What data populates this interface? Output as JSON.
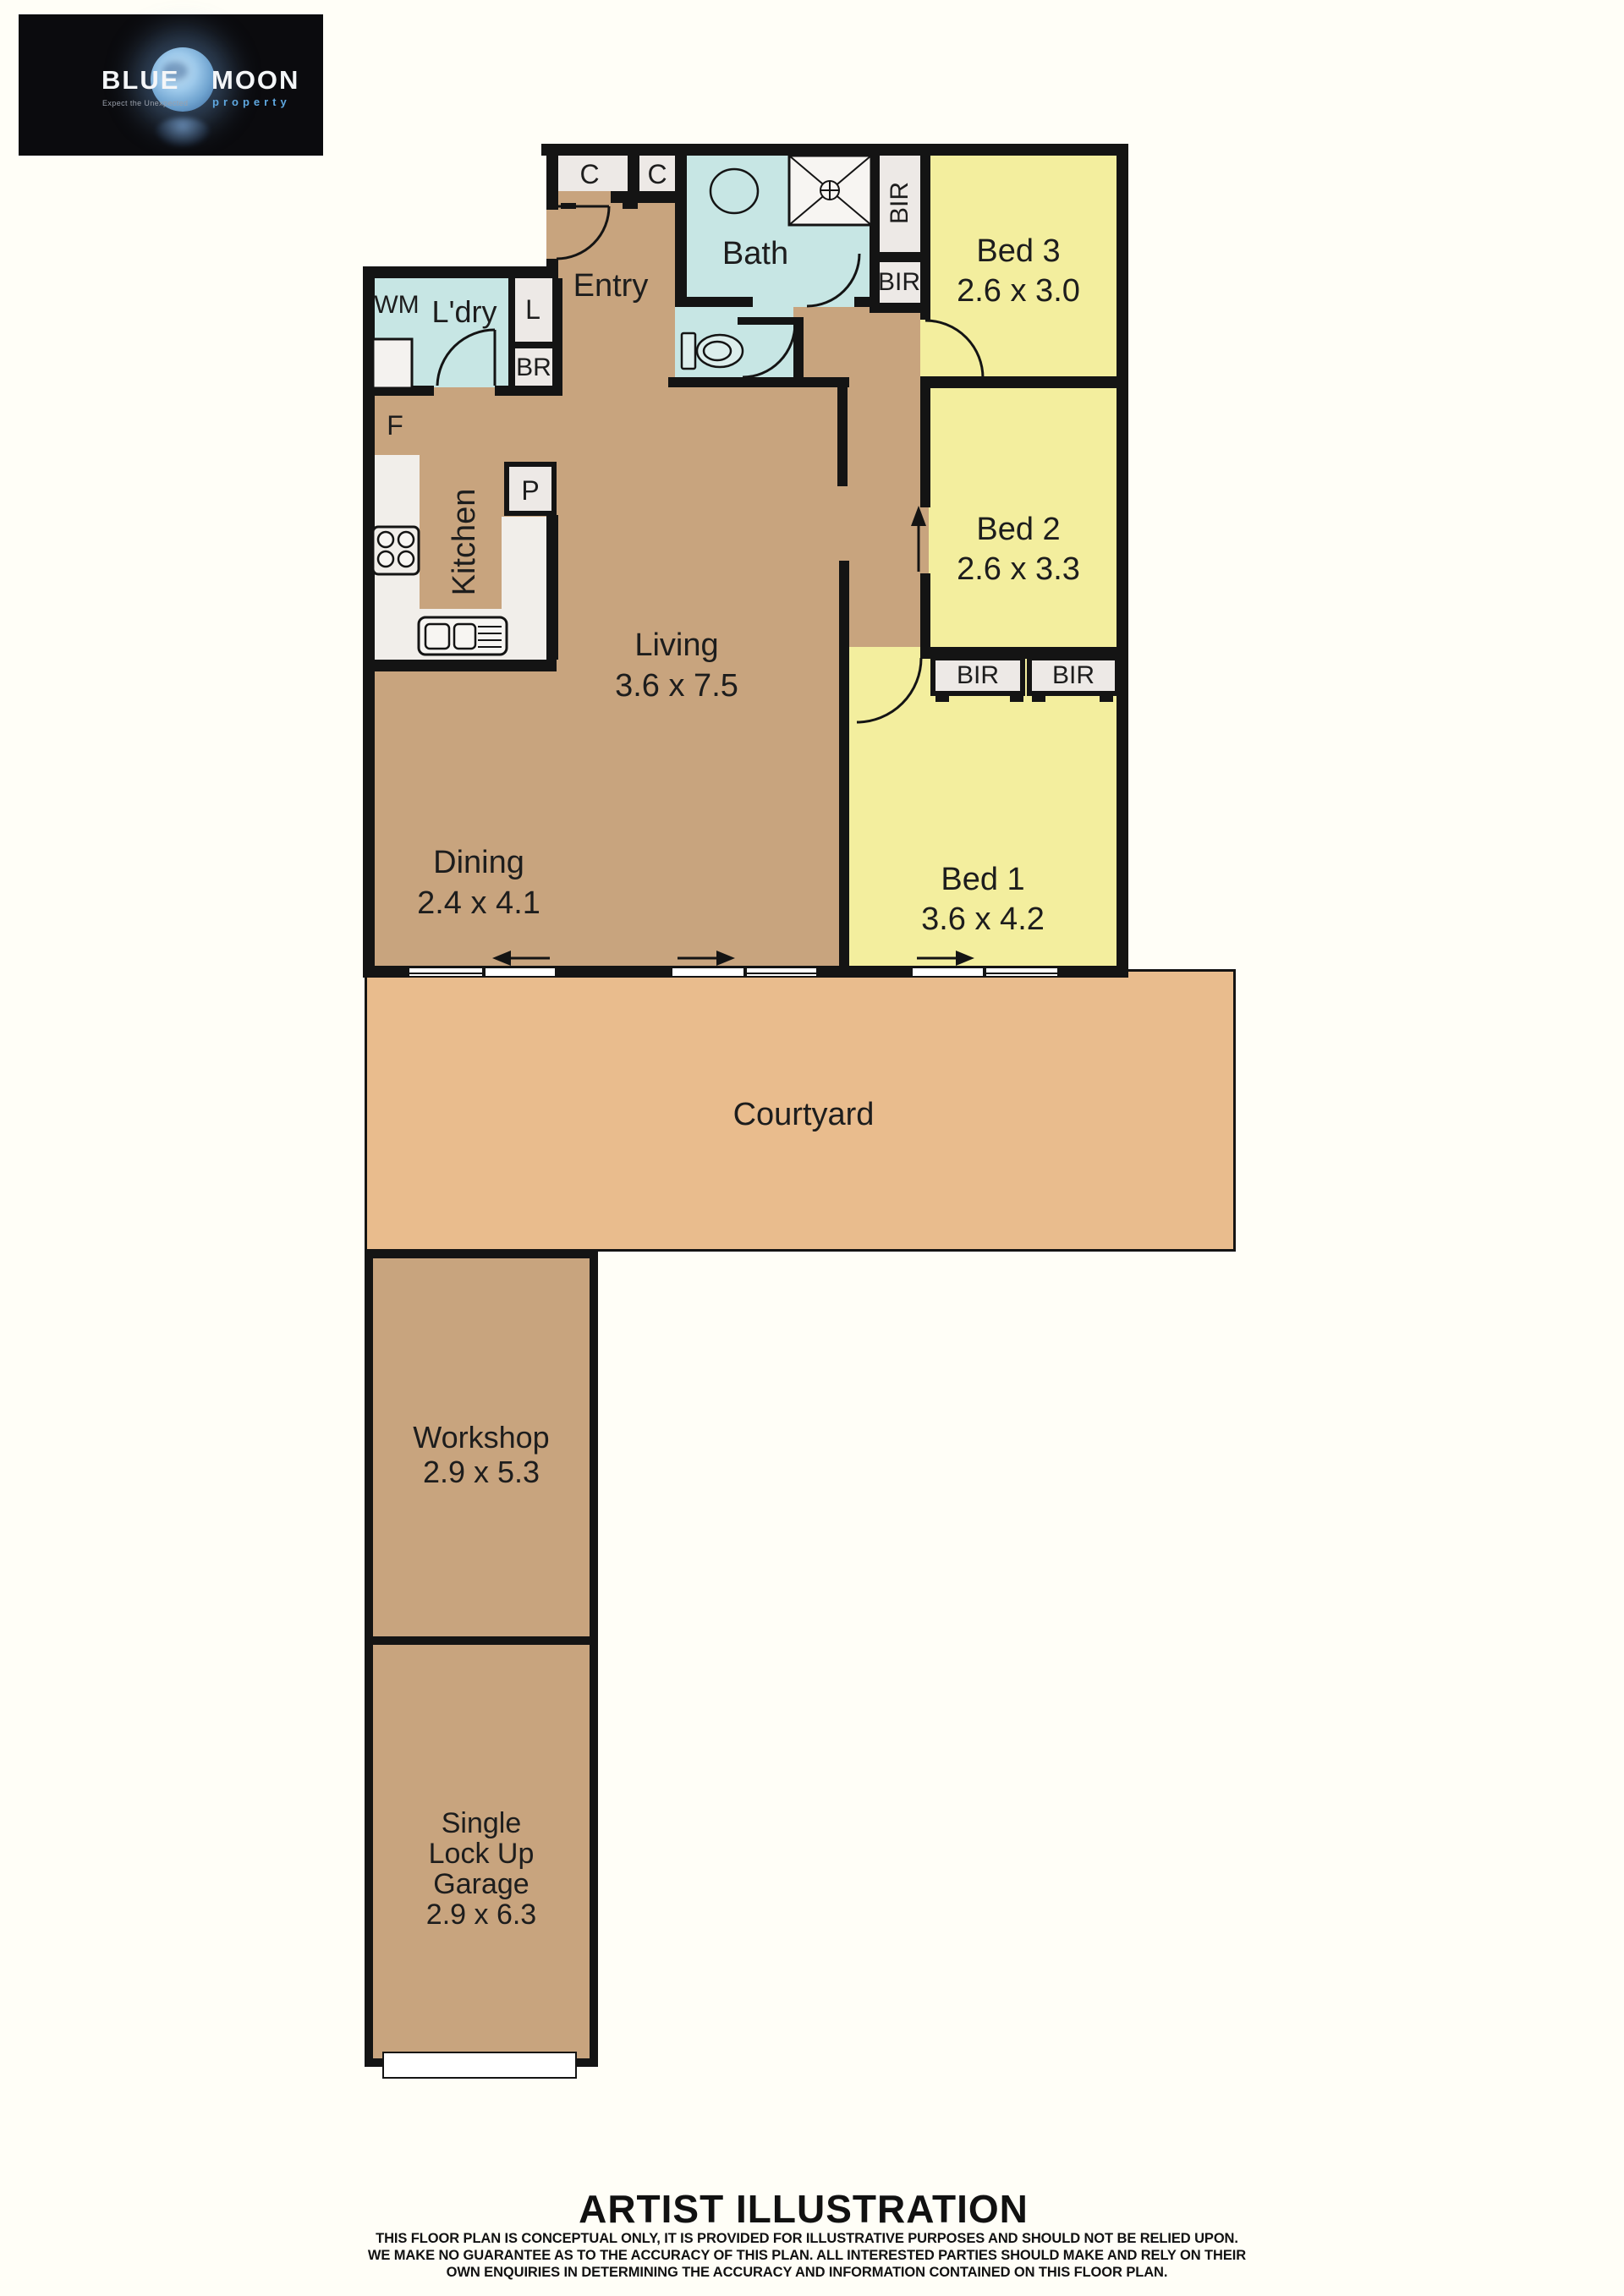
{
  "logo": {
    "word1": "BLUE",
    "word2": "MOON",
    "tagline": "Expect the Unexpected",
    "subtitle": "property"
  },
  "plan": {
    "rooms": {
      "entry": {
        "label": "Entry"
      },
      "laundry": {
        "label": "L'dry"
      },
      "bath": {
        "label": "Bath"
      },
      "kitchen": {
        "label": "Kitchen"
      },
      "living": {
        "label": "Living",
        "dims": "3.6 x 7.5"
      },
      "dining": {
        "label": "Dining",
        "dims": "2.4 x 4.1"
      },
      "bed1": {
        "label": "Bed 1",
        "dims": "3.6 x 4.2"
      },
      "bed2": {
        "label": "Bed 2",
        "dims": "2.6 x 3.3"
      },
      "bed3": {
        "label": "Bed 3",
        "dims": "2.6 x 3.0"
      },
      "courtyard": {
        "label": "Courtyard"
      },
      "workshop": {
        "label": "Workshop",
        "dims": "2.9 x 5.3"
      },
      "garage": {
        "line1": "Single",
        "line2": "Lock Up",
        "line3": "Garage",
        "dims": "2.9 x 6.3"
      }
    },
    "fixtures": {
      "wm": "WM",
      "fridge": "F",
      "pantry": "P",
      "linen": "L",
      "broom": "BR",
      "closet1": "C",
      "closet2": "C",
      "bir1": "BIR",
      "bir2": "BIR",
      "bir3": "BIR",
      "bir4": "BIR"
    }
  },
  "footer": {
    "title": "ARTIST ILLUSTRATION",
    "disclaimer": [
      "THIS FLOOR PLAN IS CONCEPTUAL ONLY, IT IS PROVIDED FOR ILLUSTRATIVE PURPOSES AND SHOULD NOT BE RELIED UPON.",
      "WE MAKE NO GUARANTEE AS TO THE ACCURACY OF THIS PLAN. ALL INTERESTED PARTIES SHOULD MAKE AND RELY ON THEIR",
      "OWN ENQUIRIES IN DETERMINING THE ACCURACY AND INFORMATION CONTAINED ON THIS FLOOR PLAN."
    ]
  },
  "colors": {
    "floor_tan": "#C8A47E",
    "courtyard_tan": "#E9BC8D",
    "bedroom_yellow": "#F3EE9E",
    "wet_area_blue": "#C7E6E4",
    "closet_grey": "#EDE9E6",
    "wall_black": "#141414",
    "logo_blue": "#5FA8E0",
    "background": "#FFFEF7"
  }
}
